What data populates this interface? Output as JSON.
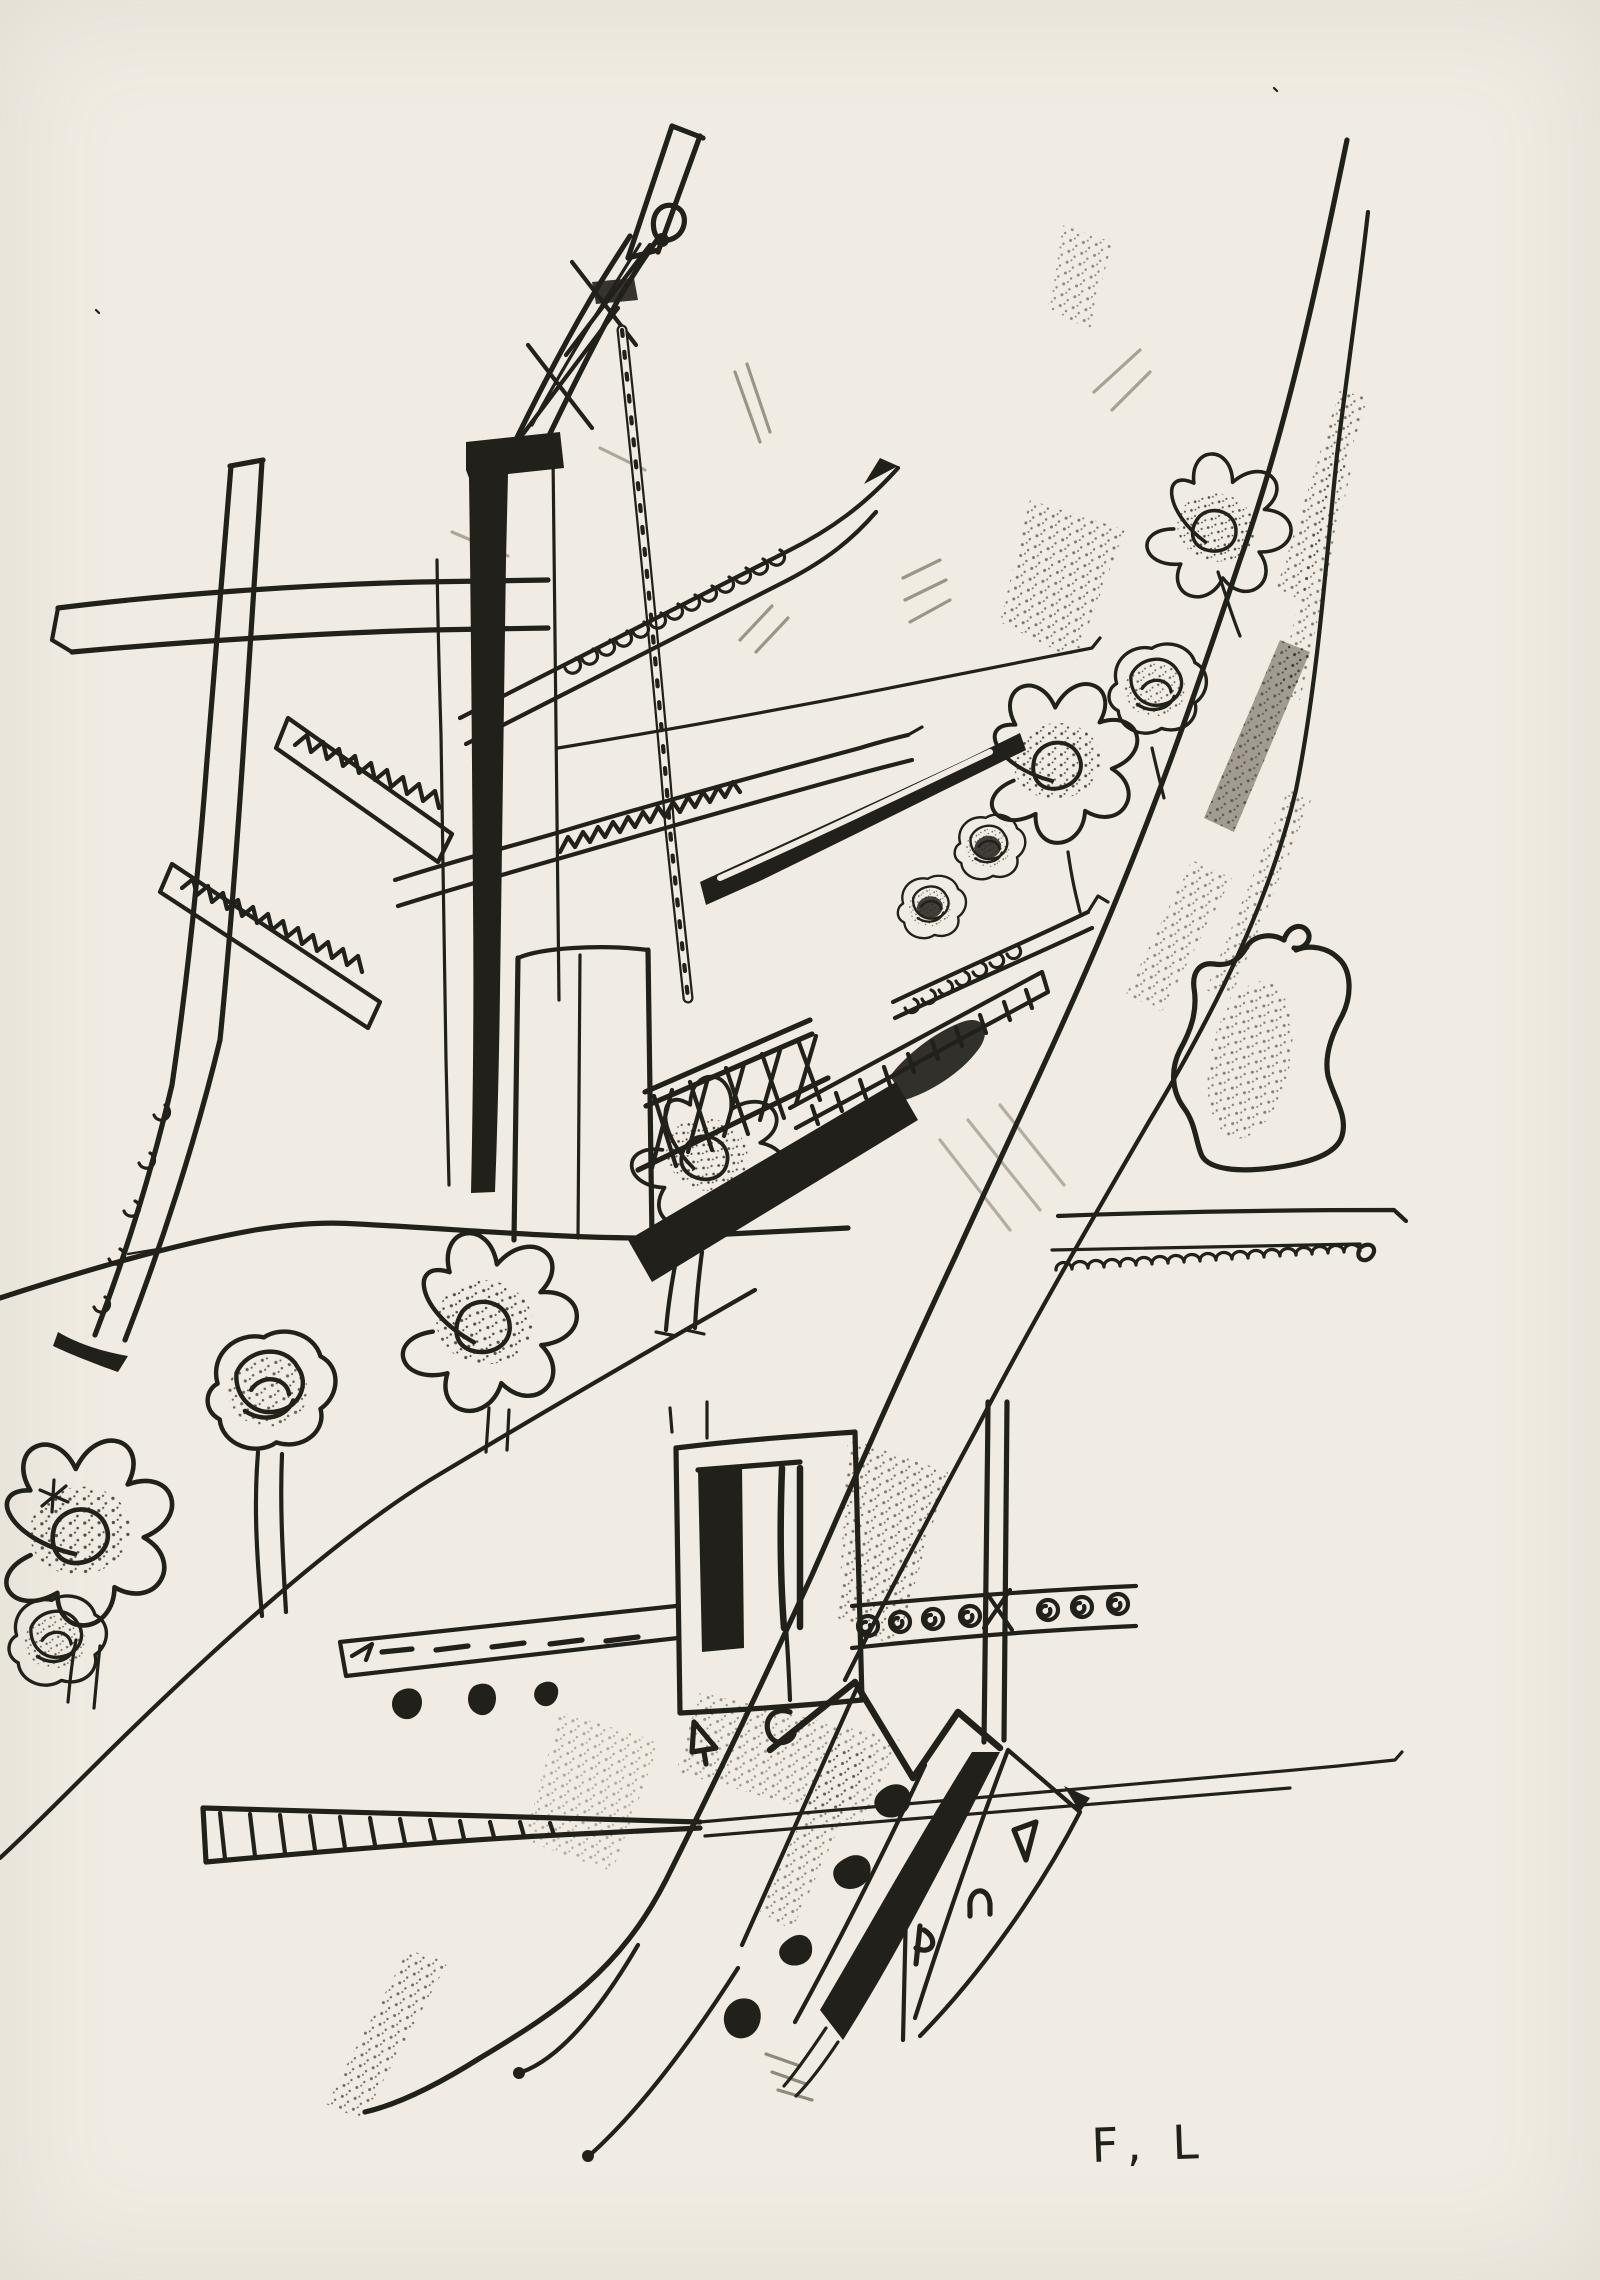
{
  "artwork": {
    "signature": "F, L",
    "palette": {
      "paper": "#f0ece3",
      "ink": "#22201b",
      "smudge": "#76705f"
    }
  }
}
